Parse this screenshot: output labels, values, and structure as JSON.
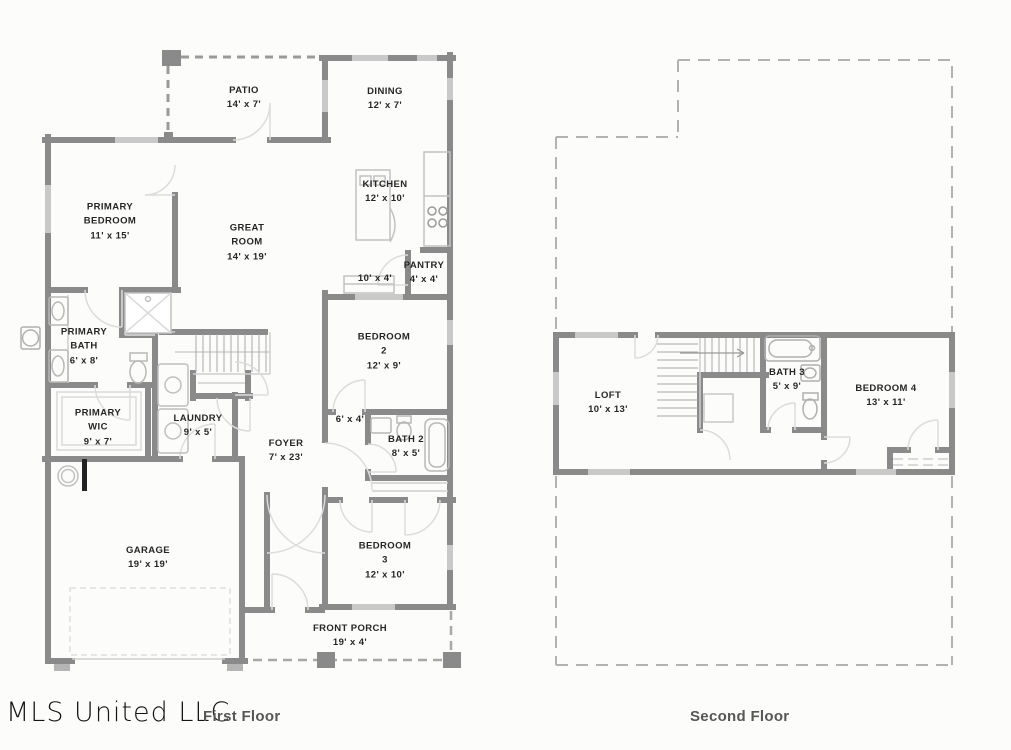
{
  "watermark": "MLS United LLC",
  "captions": {
    "first_floor": "First Floor",
    "second_floor": "Second Floor"
  },
  "colors": {
    "wall": "#8a8a8a",
    "window": "#c9c9c9",
    "fixture": "#b8b8b8",
    "door_arc": "#dcdcdc",
    "dashed_outline": "#b2b2b2",
    "patio_dash": "#9a9a9a",
    "label_text": "#262626",
    "caption_text": "#575757",
    "background": "#fcfcfb"
  },
  "first_floor": {
    "rooms": [
      {
        "name": "PATIO",
        "dims": "14' x 7'"
      },
      {
        "name": "DINING",
        "dims": "12' x 7'"
      },
      {
        "name": "PRIMARY\nBEDROOM",
        "dims": "11' x 15'"
      },
      {
        "name": "GREAT\nROOM",
        "dims": "14' x 19'"
      },
      {
        "name": "KITCHEN",
        "dims": "12' x 10'"
      },
      {
        "name": "PANTRY",
        "dims": "4' x 4'"
      },
      {
        "name": "",
        "dims": "10' x 4'"
      },
      {
        "name": "PRIMARY\nBATH",
        "dims": "6' x 8'"
      },
      {
        "name": "PRIMARY\nWIC",
        "dims": "9' x 7'"
      },
      {
        "name": "LAUNDRY",
        "dims": "9' x 5'"
      },
      {
        "name": "FOYER",
        "dims": "7' x 23'"
      },
      {
        "name": "BEDROOM\n2",
        "dims": "12' x 9'"
      },
      {
        "name": "",
        "dims": "6' x 4'"
      },
      {
        "name": "BATH 2",
        "dims": "8' x 5'"
      },
      {
        "name": "BEDROOM\n3",
        "dims": "12' x 10'"
      },
      {
        "name": "GARAGE",
        "dims": "19' x 19'"
      },
      {
        "name": "FRONT PORCH",
        "dims": "19' x 4'"
      }
    ]
  },
  "second_floor": {
    "rooms": [
      {
        "name": "LOFT",
        "dims": "10' x 13'"
      },
      {
        "name": "BATH 3",
        "dims": "5' x 9'"
      },
      {
        "name": "BEDROOM 4",
        "dims": "13' x 11'"
      }
    ]
  }
}
